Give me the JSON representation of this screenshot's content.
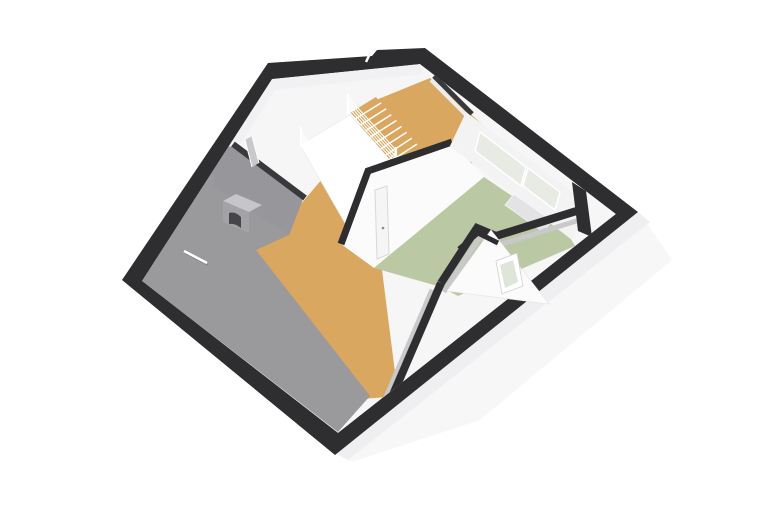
{
  "canvas": {
    "width": 762,
    "height": 508,
    "background": "#ffffff"
  },
  "scene": {
    "kind": "3d-floorplan-dollhouse-render",
    "floor_shown": "attic-level",
    "visible_text": []
  },
  "rooms": [
    {
      "name": "landing-hall",
      "floor_material": "wood",
      "floor_color": "#d9a75f"
    },
    {
      "name": "bedroom",
      "floor_material": "carpet",
      "floor_color": "#bac9a4"
    },
    {
      "name": "upper-left-room",
      "floor_material": "none",
      "floor_color": "#f6f6f7"
    },
    {
      "name": "attic-under-roof",
      "surface": "roof-slope",
      "color": "#9a999c"
    }
  ],
  "elements": [
    "exterior-walls",
    "interior-walls",
    "stairwell-void",
    "staircase",
    "stair-railing",
    "interior-door",
    "bedroom-door",
    "window-wall",
    "window-seat",
    "dormer-gable",
    "dormer-window",
    "roof-light-bar",
    "chimney",
    "knee-wall",
    "exterior-roof-slope"
  ],
  "colors": {
    "background": "#ffffff",
    "exterior_wall": "#2e2e30",
    "interior_wall_top": "#39393b",
    "wall_face_bright": "#fbfbfc",
    "wall_face_light": "#f1f1f3",
    "wall_face_shaded": "#c9c9cc",
    "roof_slope": "#9a999c",
    "roof_slope_dark": "#97969a",
    "roof_exterior": "#f4f4f5",
    "roof_exterior_edge": "#efeff1",
    "floor_wood": "#d9a75f",
    "floor_green": "#bac9a4",
    "floor_white": "#f6f6f7",
    "glass": "#e7ebe3",
    "glass_frame": "#ffffff",
    "railing": "#ffffff",
    "stair_tread": "#ffffff",
    "chimney_top": "#c6c6c9",
    "chimney_face": "#a3a3a7",
    "chimney_flue": "#46464a",
    "sill_box": "#e3e3e6",
    "dormer_glass": "#dfe5d8",
    "roof_bar": "#ffffff"
  }
}
